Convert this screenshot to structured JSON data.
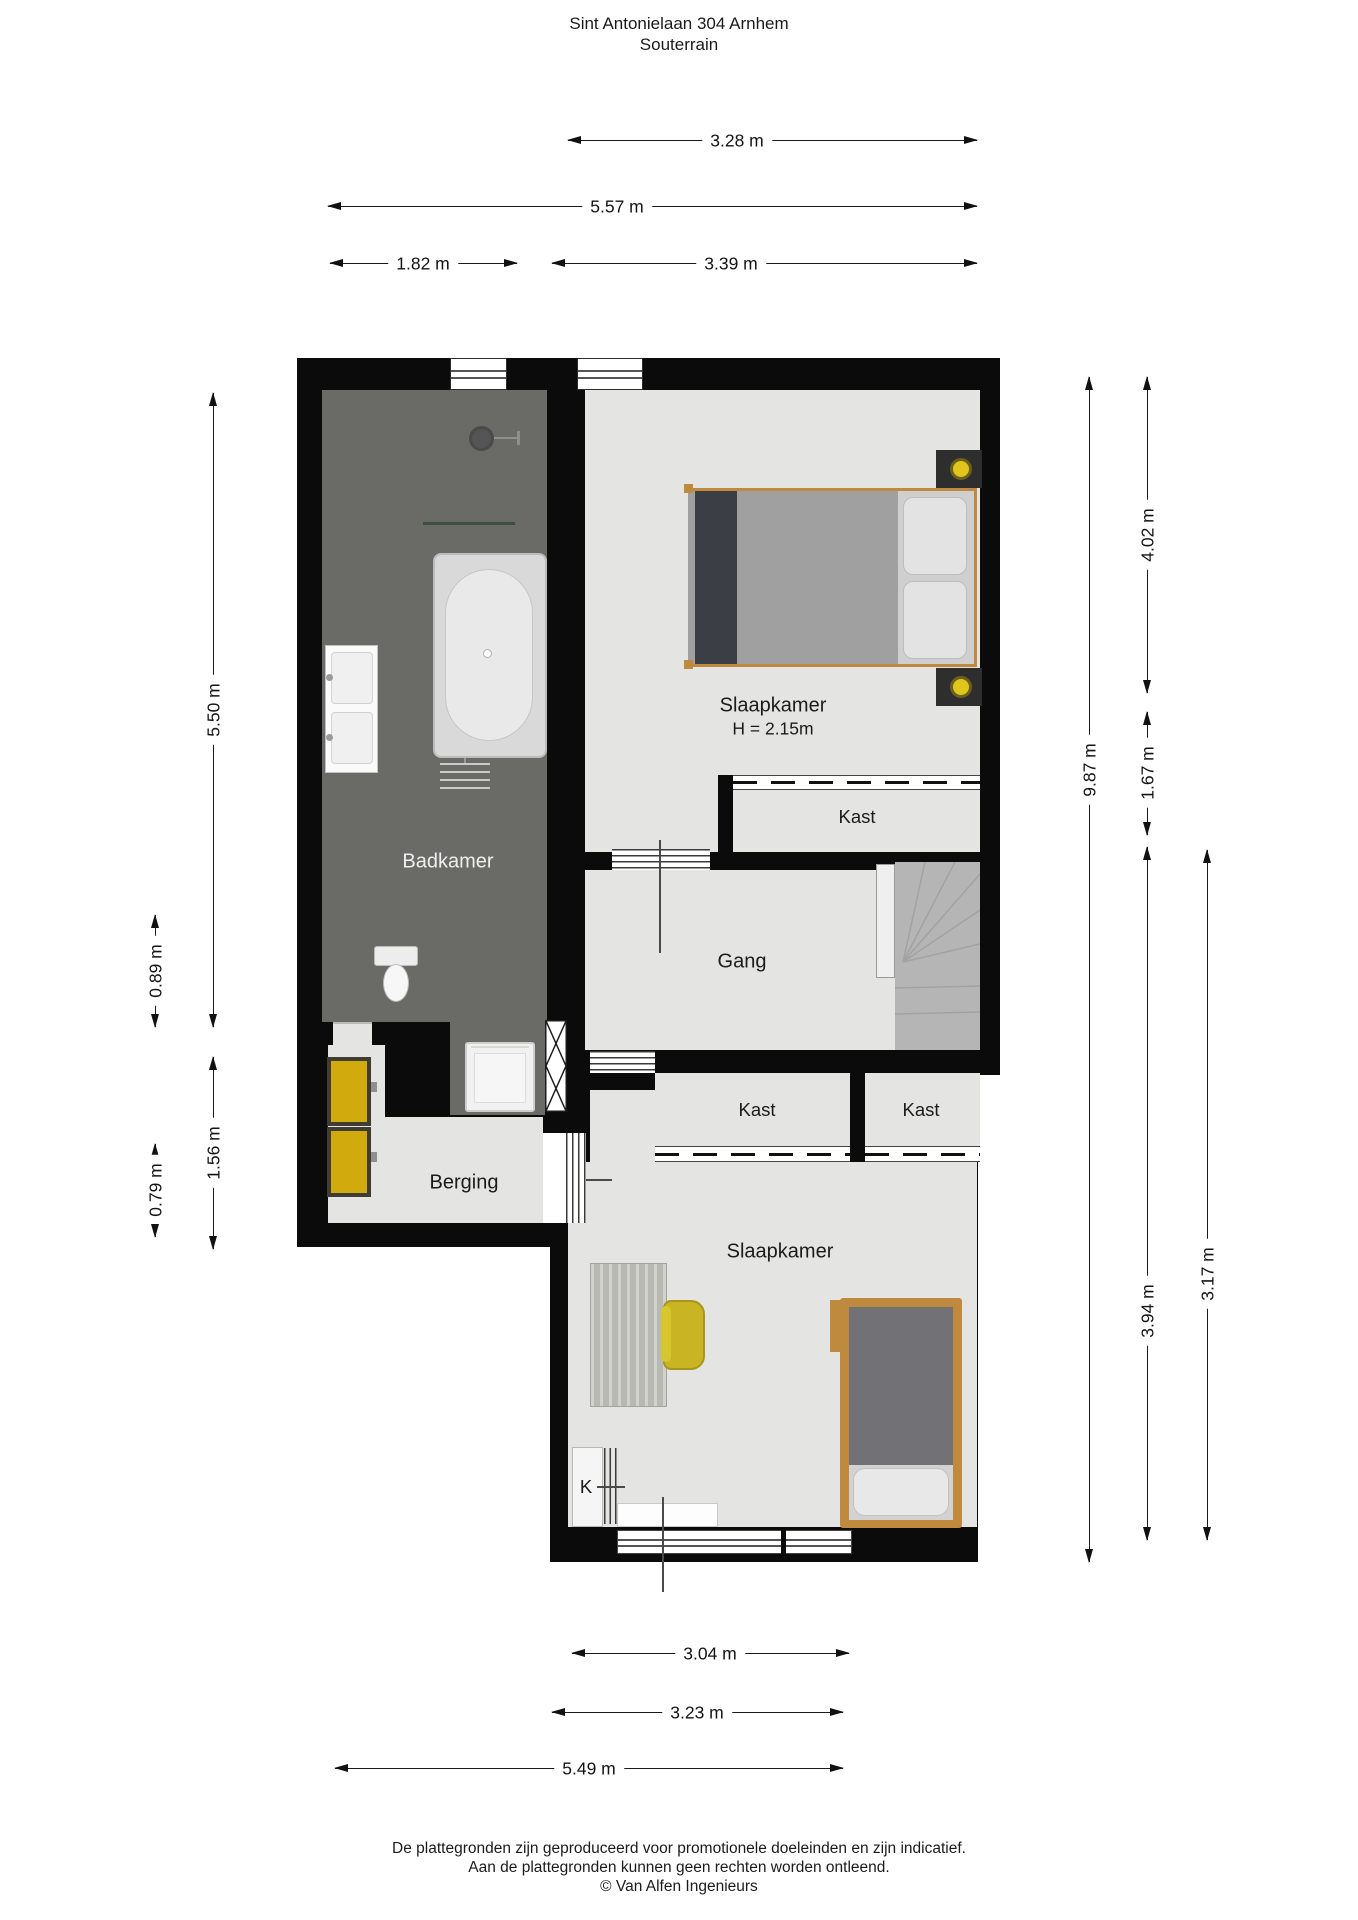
{
  "title": {
    "line1": "Sint Antonielaan 304 Arnhem",
    "line2": "Souterrain"
  },
  "rooms": {
    "badkamer": "Badkamer",
    "slaapkamer_1": "Slaapkamer",
    "slaapkamer_1_ceiling": "H = 2.15m",
    "kast_1": "Kast",
    "gang": "Gang",
    "kast_2": "Kast",
    "kast_3": "Kast",
    "berging": "Berging",
    "slaapkamer_2": "Slaapkamer",
    "kitchenette": "K"
  },
  "dimensions": {
    "top": [
      {
        "label": "3.28 m"
      },
      {
        "label": "5.57 m"
      },
      {
        "label": "1.82 m"
      },
      {
        "label": "3.39 m"
      }
    ],
    "left": [
      {
        "label": "5.50 m"
      },
      {
        "label": "0.89 m"
      },
      {
        "label": "1.56 m"
      },
      {
        "label": "0.79 m"
      }
    ],
    "right": [
      {
        "label": "9.87 m"
      },
      {
        "label": "4.02 m"
      },
      {
        "label": "1.67 m"
      },
      {
        "label": "3.94 m"
      },
      {
        "label": "3.17 m"
      }
    ],
    "bottom": [
      {
        "label": "3.04 m"
      },
      {
        "label": "3.23 m"
      },
      {
        "label": "5.49 m"
      }
    ]
  },
  "footer": {
    "line1": "De plattegronden zijn geproduceerd voor promotionele doeleinden en zijn indicatief.",
    "line2": "Aan de plattegronden kunnen geen rechten worden ontleend.",
    "line3": "© Van Alfen Ingenieurs"
  },
  "colors": {
    "wall": "#0b0b0b",
    "floor_dark": "#6a6a67",
    "floor_light": "#e4e4e2",
    "stairs": "#b5b5b5",
    "cv_unit_yellow": "#d1ab0d",
    "chair_yellow": "#c9b524",
    "bed_frame_wood": "#c08a3e",
    "dimension_line": "#1a1a1a"
  }
}
